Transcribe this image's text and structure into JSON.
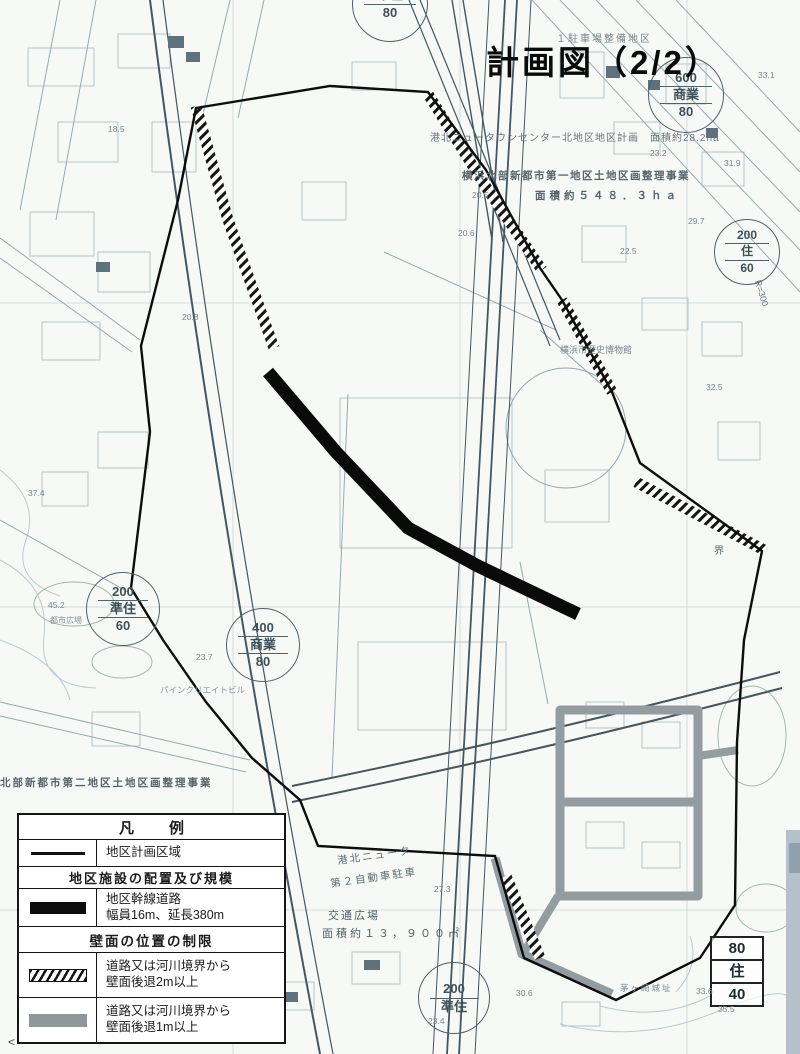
{
  "title": "計画図（2/2）",
  "legend": {
    "header": "凡　例",
    "district_boundary": "地区計画区域",
    "section_facilities": "地区施設の配置及び規模",
    "road_line1": "地区幹線道路",
    "road_line2": "幅員16m、延長380m",
    "section_wall": "壁面の位置の制限",
    "setback2m_line1": "道路又は河川境界から",
    "setback2m_line2": "壁面後退2m以上",
    "setback1m_line1": "道路又は河川境界から",
    "setback1m_line2": "壁面後退1m以上"
  },
  "annotations": {
    "parking_district": "１駐車場整備地区",
    "district_plan": "港北ニュータウンセンター北地区地区計画　面積約28.2ha",
    "land_readjust1_line1": "横浜北部新都市第一地区土地区画整理事業",
    "land_readjust1_line2": "面積約５４８．３ｈａ",
    "museum": "横浜市歴史博物館",
    "land_readjust2": "北部新都市第二地区土地区画整理事業",
    "parking_line1": "港北ニュータ",
    "parking_line2": "第２自動車駐車",
    "plaza_line1": "交通広場",
    "plaza_line2": "面積約１３，９００㎡",
    "pine_building": "パインクリエイトビル",
    "castle_ruins": "茅ヶ崎城址",
    "city_plaza": "都市広場",
    "boundary_char": "界",
    "curve_radius": "R=300",
    "corner_mark": "<"
  },
  "zoning_stamps": [
    {
      "top": "600",
      "mid": "商業",
      "bot": "80"
    },
    {
      "top": "400",
      "mid": "商業",
      "bot": "80"
    },
    {
      "top": "200",
      "mid": "準住",
      "bot": "60"
    },
    {
      "top": "200",
      "mid": "住",
      "bot": "60"
    },
    {
      "top": "200",
      "mid": "準住",
      "bot": ""
    },
    {
      "top": "準住",
      "mid": "80",
      "bot": ""
    },
    {
      "top": "80",
      "mid": "住",
      "bot": "40"
    }
  ],
  "spot_elevations": [
    "20.6",
    "20.8",
    "20.5",
    "18.5",
    "23.7",
    "37.4",
    "45.2",
    "23.2",
    "29.7",
    "31.9",
    "32.5",
    "33.6",
    "35.5",
    "30.6",
    "23.4",
    "27.3",
    "33.1",
    "22.5"
  ],
  "colors": {
    "district_boundary": "#0d0d0d",
    "arterial_road": "#0a0a0a",
    "setback_1m_gray": "#939ca1",
    "map_linework": "#45565e",
    "scan_strip": "#b5c1ca"
  }
}
